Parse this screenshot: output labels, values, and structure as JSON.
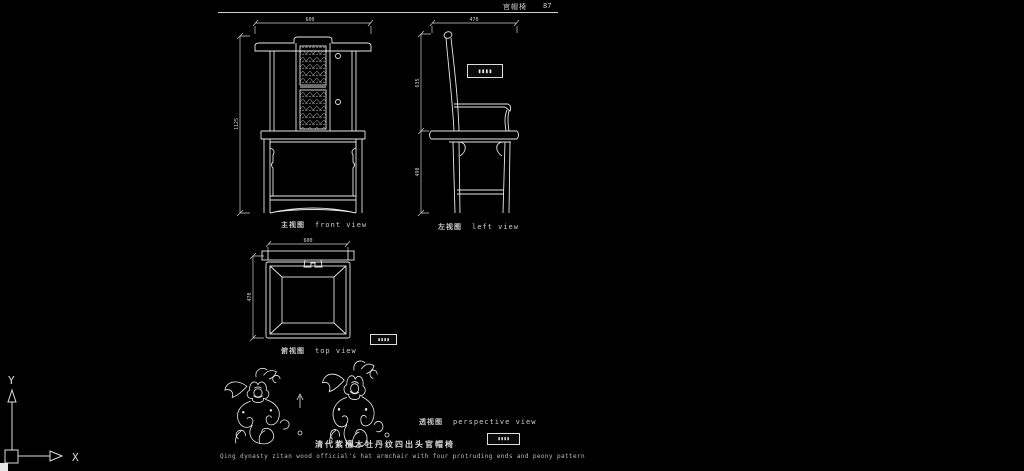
{
  "colors": {
    "background": "#000000",
    "line": "#e8e8e8",
    "dim_line": "#cfcfcf",
    "text": "#c9c9c9"
  },
  "header": {
    "sheet_title": "官帽椅",
    "sheet_number": "87"
  },
  "views": {
    "front": {
      "label_cn": "主视图",
      "label_en": "front view",
      "dims": {
        "width": "600",
        "height": "1125"
      }
    },
    "left": {
      "label_cn": "左视图",
      "label_en": "left view",
      "dims": {
        "depth": "470",
        "back_height": "635",
        "seat_height": "490"
      },
      "stamp": "▮▮▮▮"
    },
    "top": {
      "label_cn": "俯视图",
      "label_en": "top view",
      "dims": {
        "width": "600",
        "depth": "470"
      },
      "stamp": "▮▮▮▮"
    },
    "perspective": {
      "label_cn": "透视图",
      "label_en": "perspective view",
      "stamp": "▮▮▮▮"
    }
  },
  "footer": {
    "title_cn": "清代紫檀木牡丹纹四出头官帽椅",
    "title_en": "Qing dynasty zitan wood official's hat armchair with four protruding ends and peony pattern"
  },
  "ucs": {
    "x_label": "X",
    "y_label": "Y"
  }
}
